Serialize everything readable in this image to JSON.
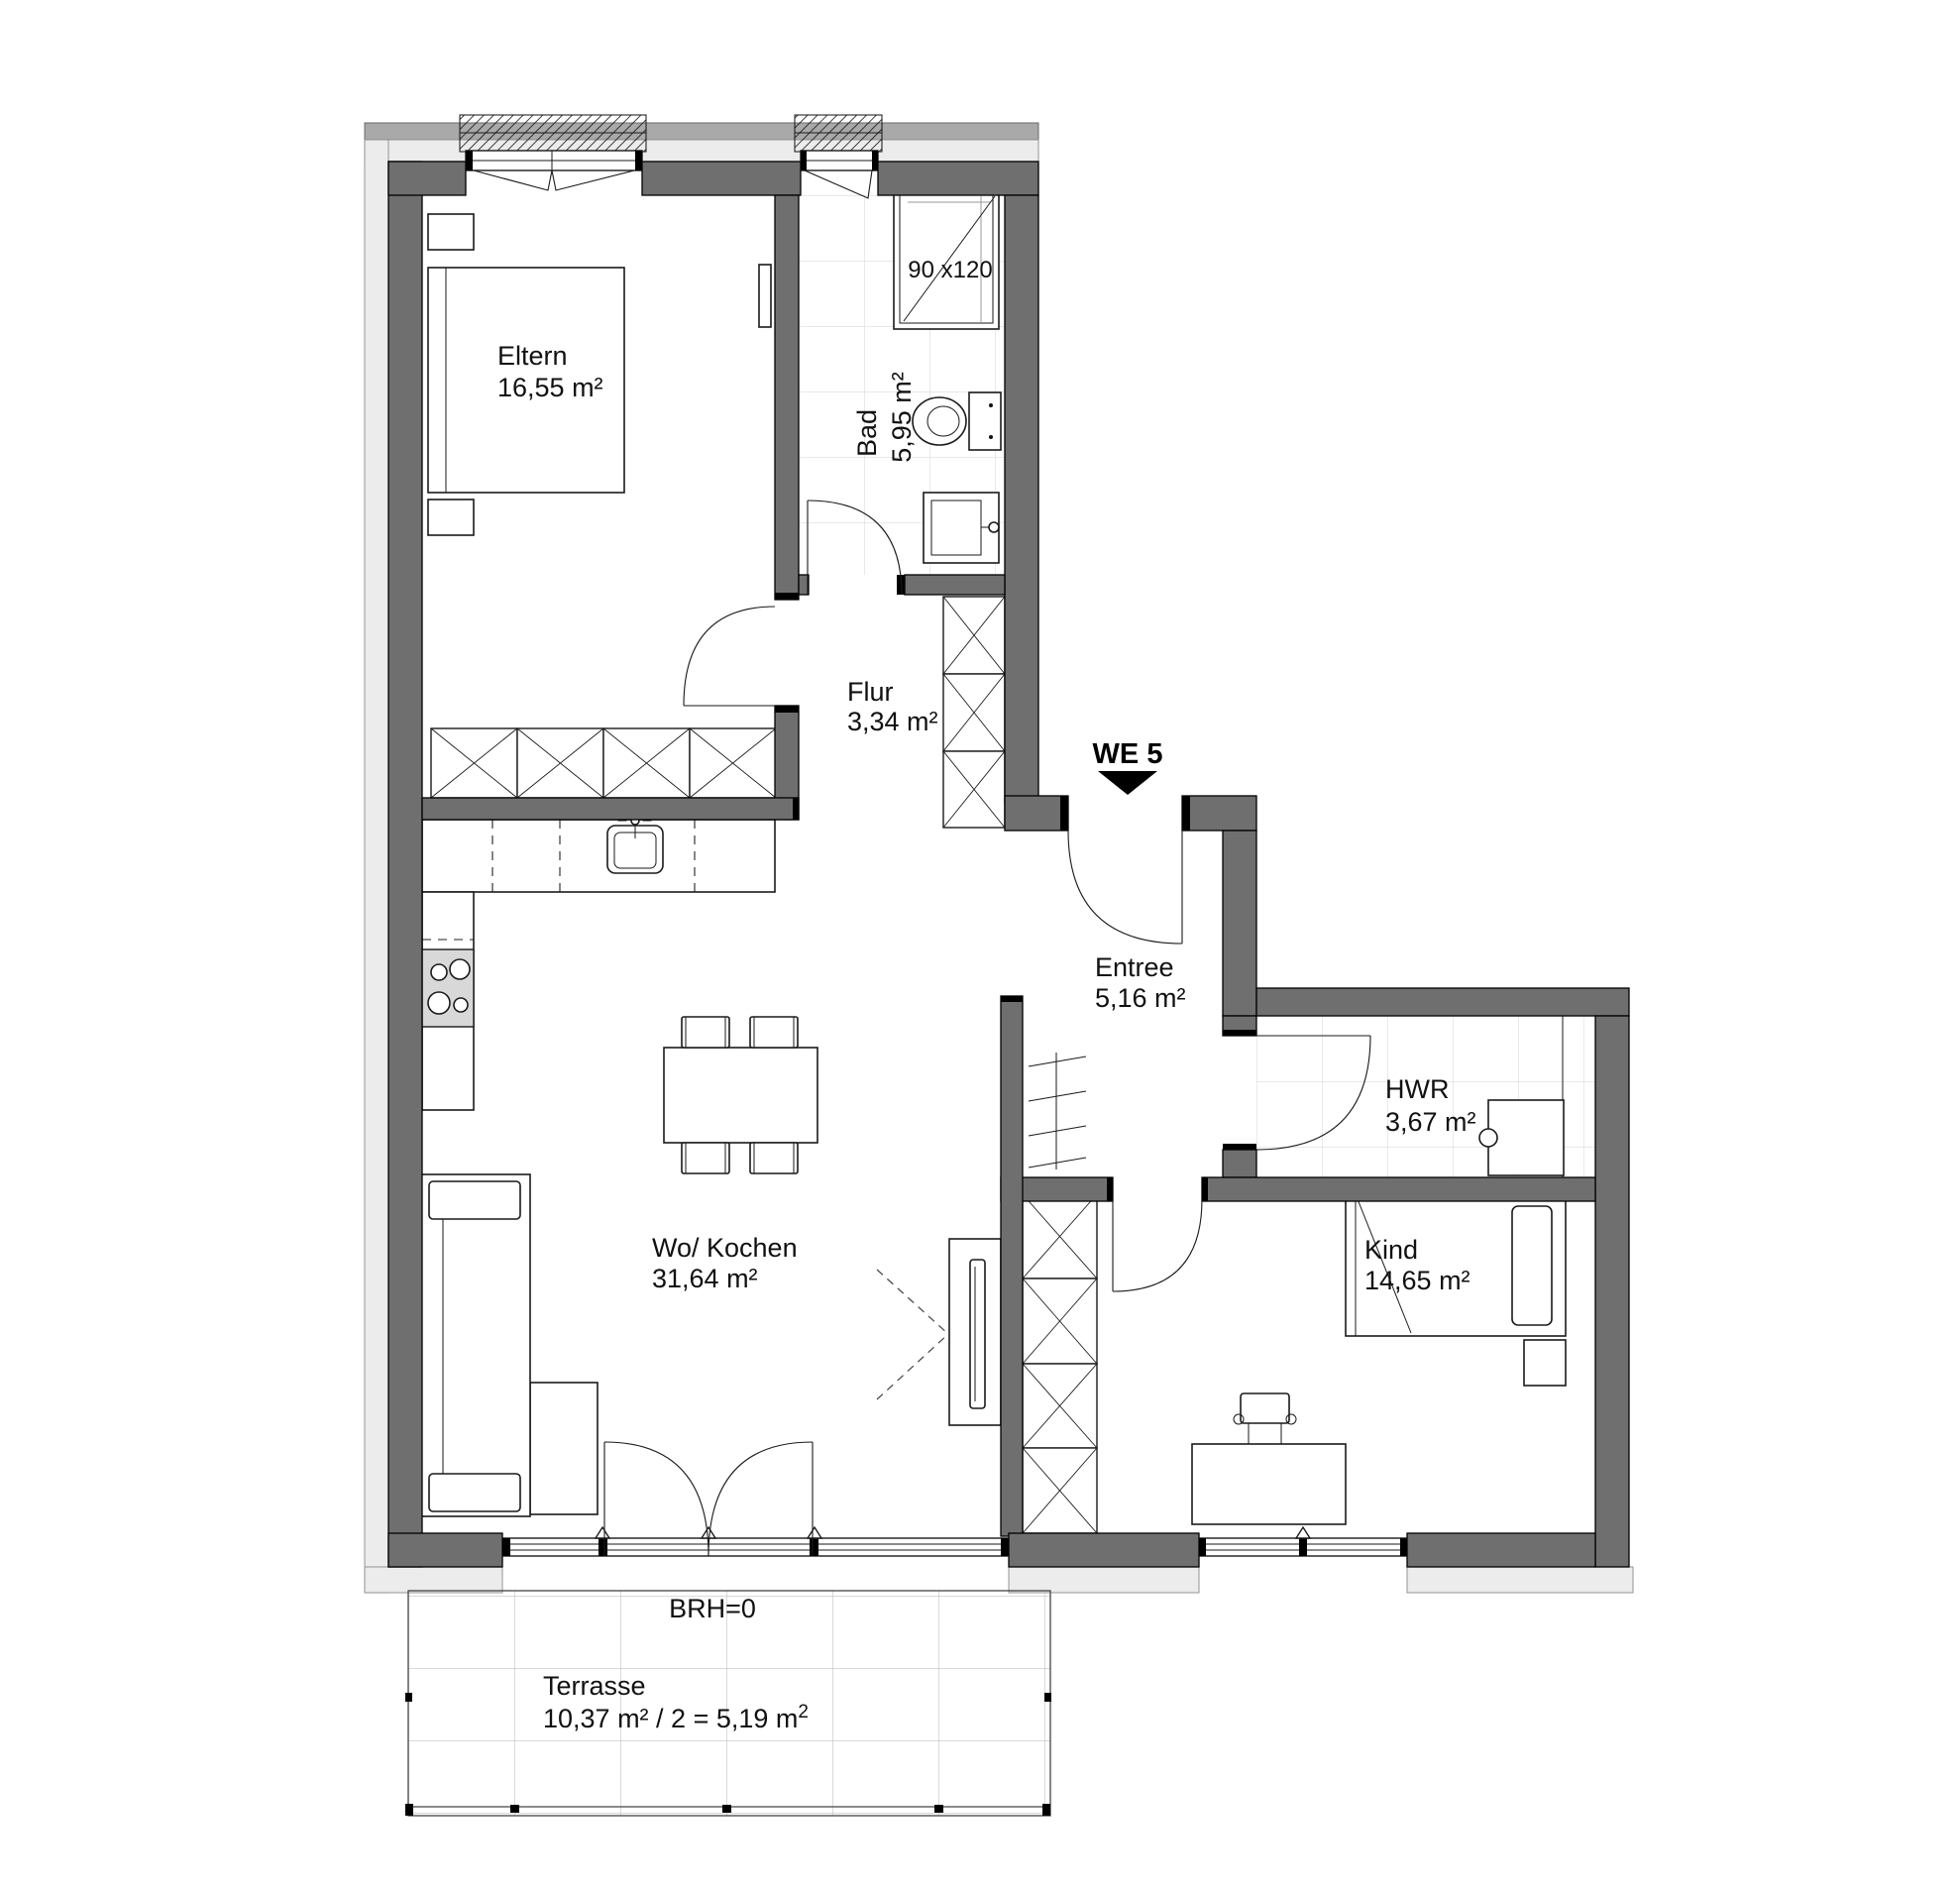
{
  "plan": {
    "unit_label": "WE 5",
    "rooms": {
      "eltern": {
        "name": "Eltern",
        "area": "16,55 m²"
      },
      "bad": {
        "name": "Bad",
        "area": "5,95 m²"
      },
      "flur": {
        "name": "Flur",
        "area": "3,34 m²"
      },
      "entree": {
        "name": "Entree",
        "area": "5,16 m²"
      },
      "hwr": {
        "name": "HWR",
        "area": "3,67 m²"
      },
      "kind": {
        "name": "Kind",
        "area": "14,65 m²"
      },
      "wohnen_kochen": {
        "name": "Wo/ Kochen",
        "area": "31,64 m²"
      },
      "terrasse": {
        "name": "Terrasse",
        "area_main": "10,37 m² / 2 = 5,19 m",
        "area_sup": "2"
      }
    },
    "annotations": {
      "shower_size": "90 x120",
      "sill_height": "BRH=0"
    },
    "colors": {
      "wall": "#6f6f6f",
      "band_light": "#ececec",
      "band_medium": "#a9a9a9",
      "tile_line": "#dcdcdc",
      "terrace_line": "#c2c2c2",
      "cooktop": "#d8d8d8"
    }
  }
}
